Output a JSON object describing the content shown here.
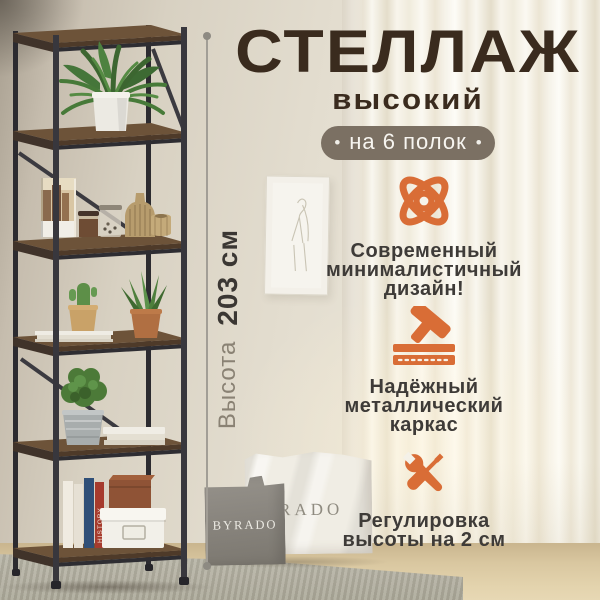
{
  "header": {
    "title": "СТЕЛЛАЖ",
    "subtitle": "высокий",
    "badge": {
      "label": "на 6 полок",
      "dot": "•"
    }
  },
  "dimension": {
    "label": "Высота",
    "value": "203 см"
  },
  "features": [
    {
      "icon": "atom-icon",
      "text": "Современный\nминималистичный\nдизайн!"
    },
    {
      "icon": "hammer-icon",
      "text": "Надёжный\nметаллический\nкаркас"
    },
    {
      "icon": "wrench-screwdriver-icon",
      "text": "Регулировка\nвысоты на 2 см"
    }
  ],
  "scene": {
    "gray_bag_label": "BYRADO",
    "white_bag_label": "RADO",
    "red_book_spine_label": "HISTORY",
    "shelf_count": "6"
  },
  "colors": {
    "accent": "#d96d36",
    "title": "#3a2b1e",
    "badge_bg": "#7b7063",
    "body_text": "#3e3b38",
    "dimension_muted": "#8a8274"
  }
}
